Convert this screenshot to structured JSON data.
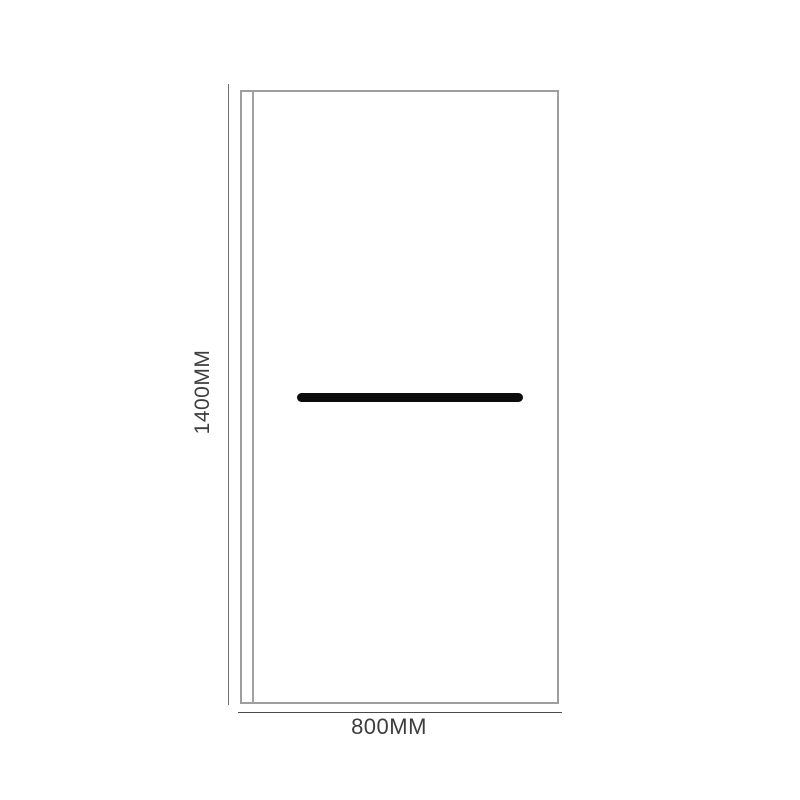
{
  "diagram": {
    "height_label": "1400MM",
    "width_label": "800MM",
    "colors": {
      "panel_border": "#9e9e9e",
      "wall_profile_line": "#a2a2a2",
      "height_dimension_line": "#6f6f6f",
      "width_dimension_line": "#4a4a4a",
      "label_text": "#3d3d3d",
      "towel_bar": "#0b0b0b",
      "background": "#ffffff"
    }
  }
}
